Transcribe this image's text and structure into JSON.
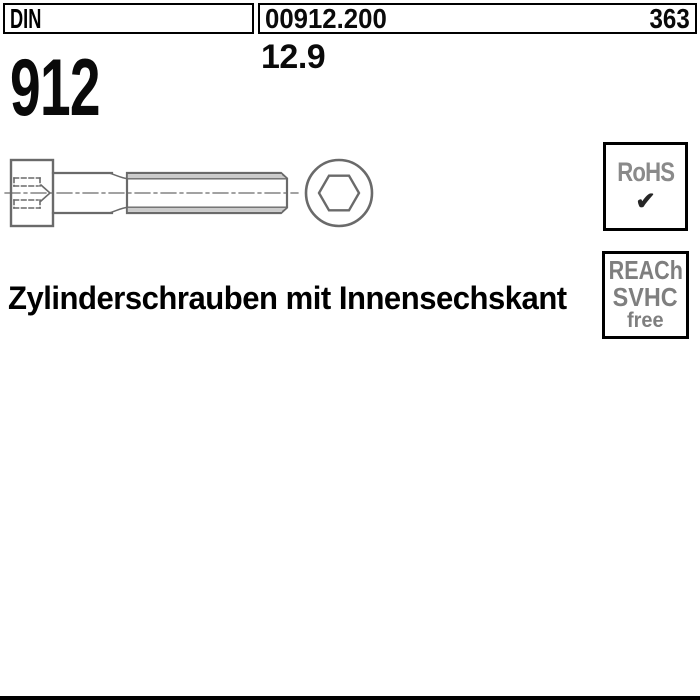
{
  "header": {
    "din_label": "DIN",
    "standard_number": "912",
    "article_number": "00912.200",
    "page_number": "363",
    "strength_class": "12.9"
  },
  "title": "Zylinderschrauben mit Innensechskant",
  "badges": {
    "rohs": {
      "label": "RoHS",
      "check": "✔"
    },
    "reach": {
      "line1": "REACh",
      "line2": "SVHC",
      "line3": "free"
    }
  },
  "drawing": {
    "description": "Socket head cap screw, side view with hidden hex socket lines and end view",
    "line_color": "#6a6a6a",
    "shade_color": "#cbcbcb"
  },
  "colors": {
    "background": "#ffffff",
    "border": "#000000",
    "badge_text": "#7f7f7f",
    "bottom_bar": "#000000"
  }
}
